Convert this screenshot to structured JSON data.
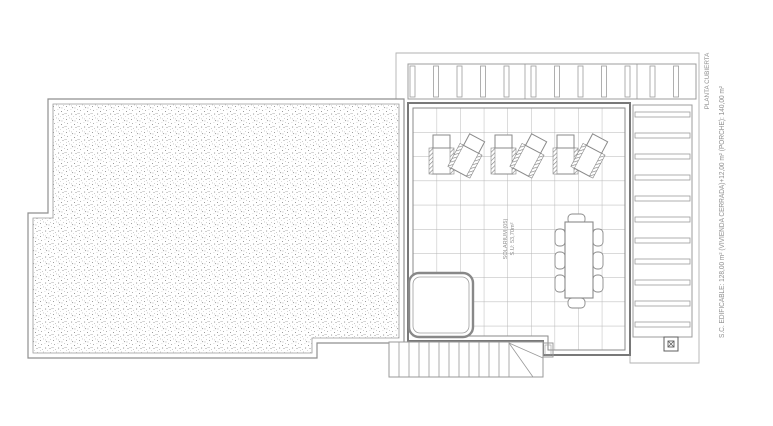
{
  "plan": {
    "title": "PLANTA CUBIERTA",
    "side_note": "S.C. EDIFICABLE: 128,00 m² (VIVIENDA CERRADA)+12,00 m² (PORCHE): 140,00 m²",
    "solarium": {
      "label": "SOLARIUM (05)",
      "area": "S.U: 53,70m²"
    },
    "symbols": {
      "drain": "roof-drain ⊠"
    },
    "colors": {
      "background": "#ffffff",
      "line_main": "#787878",
      "line_light": "#9c9c9c",
      "outer_boundary": "#b2b2b2",
      "tile_grid": "#b3b3b3",
      "stipple_dots": "#a5a5a5",
      "annotation_text": "#8f8f8f"
    }
  }
}
